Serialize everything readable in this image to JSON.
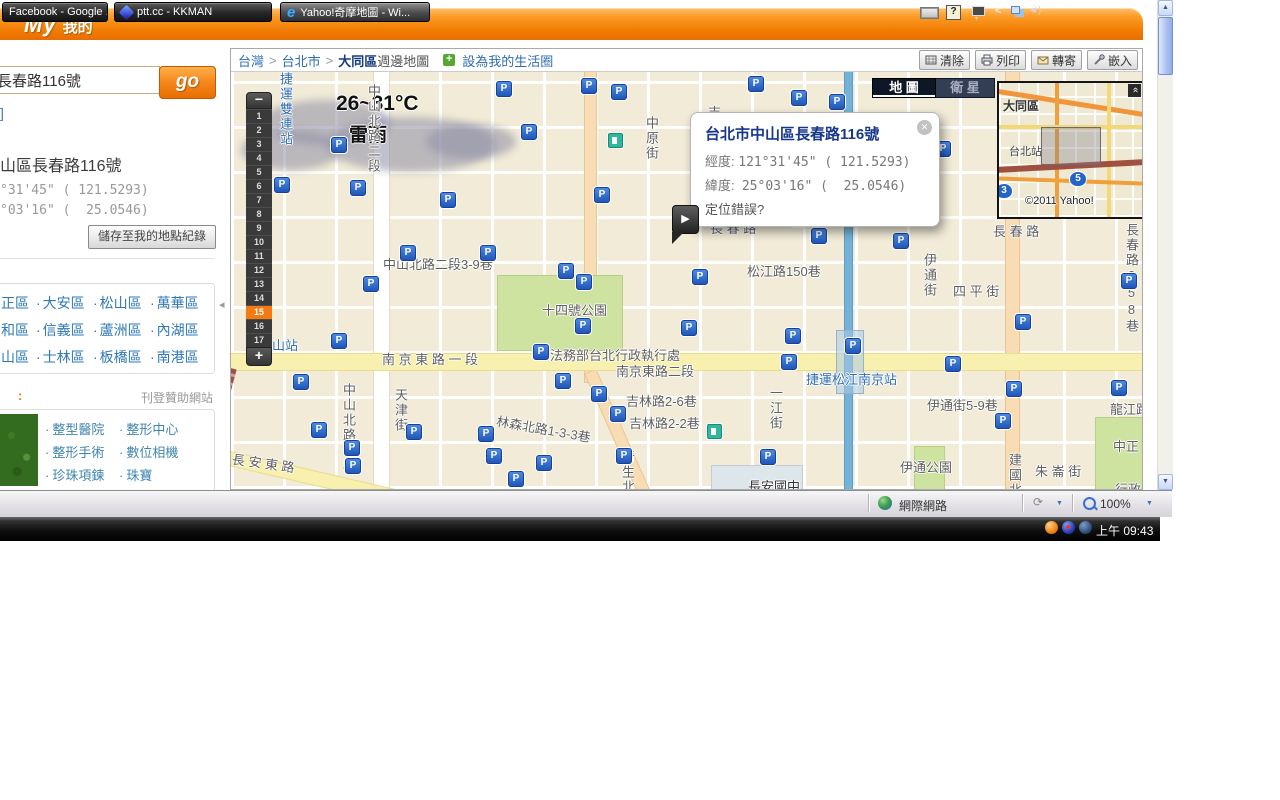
{
  "colors": {
    "header_orange": "#f07b00",
    "accent_zoom_selected": "#f57a12",
    "link_blue": "#2e79b8",
    "marker_blue": "#2057b8",
    "mrt_text_blue": "#2e6db4"
  },
  "header": {
    "logo_my": "My",
    "logo_suffix": "我的"
  },
  "sidebar": {
    "search_value": "長春路116號",
    "go_label": "go",
    "bracket": "]",
    "result_title": "山區長春路116號",
    "coord_line1": "°31'45\" ( 121.5293)",
    "coord_line2": "°03'16\" (  25.0546)",
    "save_button": "儲存至我的地點紀錄",
    "districts": [
      [
        "正區",
        "大安區",
        "松山區",
        "萬華區"
      ],
      [
        "和區",
        "信義區",
        "蘆洲區",
        "內湖區"
      ],
      [
        "山區",
        "士林區",
        "板橋區",
        "南港區"
      ]
    ],
    "sponsor_colon": ":",
    "sponsor_label": "刊登贊助網站",
    "ad_links": [
      [
        "整型醫院",
        "整形中心"
      ],
      [
        "整形手術",
        "數位相機"
      ],
      [
        "珍珠項鍊",
        "珠寶"
      ]
    ]
  },
  "breadcrumb": {
    "region": "台灣",
    "city": "台北市",
    "sep": ">",
    "district": "大同區",
    "suffix": "週邊地圖",
    "life_circle": "設為我的生活圈",
    "plus": "+"
  },
  "toolbar": {
    "clear": "清除",
    "print": "列印",
    "forward": "轉寄",
    "embed": "嵌入"
  },
  "map": {
    "weather": {
      "temp": "26~31°C",
      "condition": "雷雨"
    },
    "zoom": {
      "minus": "−",
      "plus": "+",
      "levels": [
        1,
        2,
        3,
        4,
        5,
        6,
        7,
        8,
        9,
        10,
        11,
        12,
        13,
        14,
        15,
        16,
        17
      ],
      "selected": 15
    },
    "type_buttons": {
      "map": "地 圖",
      "satellite": "衛 星"
    },
    "minimap": {
      "district": "大同區",
      "station": "台北站",
      "shield_a": "5",
      "shield_b": "3",
      "copyright": "©2011 Yahoo!"
    },
    "popup": {
      "title": "台北市中山區長春路116號",
      "lon_label": "經度:",
      "lon_value": "121°31'45\" ( 121.5293)",
      "lat_label": "緯度:",
      "lat_value": "25°03'16\" (  25.0546)",
      "error_link": "定位錯誤?"
    },
    "marker_glyph": "P",
    "labels": [
      {
        "t": "中山北路二段3-9巷",
        "x": 152,
        "y": 182
      },
      {
        "t": "長 春 路",
        "x": 479,
        "y": 146
      },
      {
        "t": "長 春 路",
        "x": 762,
        "y": 149
      },
      {
        "t": "松江路150巷",
        "x": 516,
        "y": 189
      },
      {
        "t": "十四號公園",
        "x": 311,
        "y": 228
      },
      {
        "t": "法務部台北行政執行處",
        "x": 319,
        "y": 273
      },
      {
        "t": "南 京 東 路 一 段",
        "x": 151,
        "y": 277
      },
      {
        "t": "南京東路二段",
        "x": 385,
        "y": 289
      },
      {
        "t": "捷運松江南京站",
        "x": 575,
        "y": 297,
        "c": "mrt"
      },
      {
        "t": "吉林路2-6巷",
        "x": 395,
        "y": 319
      },
      {
        "t": "吉林路2-2巷",
        "x": 398,
        "y": 341
      },
      {
        "t": "林森北路1-3-3巷",
        "x": 265,
        "y": 347,
        "r": 10
      },
      {
        "t": "一江街",
        "x": 535,
        "y": 314,
        "v": 1
      },
      {
        "t": "伊通街",
        "x": 689,
        "y": 181,
        "v": 1
      },
      {
        "t": "四 平 街",
        "x": 722,
        "y": 209
      },
      {
        "t": "伊通街5-9巷",
        "x": 696,
        "y": 323
      },
      {
        "t": "伊通公園",
        "x": 669,
        "y": 385
      },
      {
        "t": "建國北路",
        "x": 774,
        "y": 381,
        "v": 1
      },
      {
        "t": "朱 崙 街",
        "x": 804,
        "y": 389
      },
      {
        "t": "龍江路",
        "x": 879,
        "y": 327
      },
      {
        "t": "中正",
        "x": 882,
        "y": 364
      },
      {
        "t": "行政",
        "x": 884,
        "y": 407
      },
      {
        "t": "長春路258巷",
        "x": 891,
        "y": 151,
        "v": 1
      },
      {
        "t": "中原街",
        "x": 411,
        "y": 44,
        "v": 1
      },
      {
        "t": "吉",
        "x": 477,
        "y": 30
      },
      {
        "t": "中山北路一段",
        "x": 108,
        "y": 311,
        "v": 1
      },
      {
        "t": "天津街",
        "x": 160,
        "y": 316,
        "v": 1
      },
      {
        "t": "長 安 東 路",
        "x": 1,
        "y": 381,
        "r": 8
      },
      {
        "t": "新生北路",
        "x": 387,
        "y": 378,
        "v": 1
      },
      {
        "t": "長安國中",
        "x": 517,
        "y": 404,
        "c": "dark"
      },
      {
        "t": "中山北路二段",
        "x": 133,
        "y": 12,
        "v": 1
      },
      {
        "t": "捷運雙連站",
        "x": 45,
        "y": 0,
        "v": 1,
        "c": "mrt"
      },
      {
        "t": "山站",
        "x": 41,
        "y": 263,
        "c": "mrt"
      }
    ],
    "markers": [
      [
        272,
        16
      ],
      [
        357,
        13
      ],
      [
        387,
        19
      ],
      [
        524,
        11
      ],
      [
        567,
        25
      ],
      [
        605,
        29
      ],
      [
        107,
        72
      ],
      [
        297,
        59
      ],
      [
        216,
        127
      ],
      [
        126,
        115
      ],
      [
        370,
        122
      ],
      [
        50,
        112
      ],
      [
        711,
        76
      ],
      [
        176,
        180
      ],
      [
        256,
        180
      ],
      [
        334,
        198
      ],
      [
        352,
        209
      ],
      [
        139,
        211
      ],
      [
        107,
        268
      ],
      [
        351,
        253
      ],
      [
        309,
        279
      ],
      [
        567,
        146
      ],
      [
        587,
        163
      ],
      [
        669,
        168
      ],
      [
        468,
        204
      ],
      [
        457,
        255
      ],
      [
        561,
        263
      ],
      [
        557,
        289
      ],
      [
        721,
        291
      ],
      [
        791,
        249
      ],
      [
        897,
        208
      ],
      [
        621,
        273
      ],
      [
        331,
        308
      ],
      [
        367,
        321
      ],
      [
        386,
        341
      ],
      [
        254,
        361
      ],
      [
        262,
        383
      ],
      [
        312,
        390
      ],
      [
        284,
        406
      ],
      [
        392,
        383
      ],
      [
        536,
        384
      ],
      [
        69,
        309
      ],
      [
        87,
        357
      ],
      [
        120,
        375
      ],
      [
        121,
        393
      ],
      [
        182,
        359
      ],
      [
        782,
        316
      ],
      [
        771,
        348
      ],
      [
        887,
        315
      ]
    ],
    "gas_stations": [
      [
        383,
        67
      ],
      [
        482,
        358
      ]
    ]
  },
  "statusbar": {
    "zone": "網際網路",
    "zoom_level": "100%"
  },
  "taskbar": {
    "windows": [
      {
        "title": "Facebook - Google ...",
        "icon": "none"
      },
      {
        "title": "ptt.cc - KKMAN",
        "icon": "kkman"
      },
      {
        "title": "Yahoo!奇摩地圖 - Wi...",
        "icon": "ie"
      }
    ],
    "clock": "上午 09:43"
  }
}
